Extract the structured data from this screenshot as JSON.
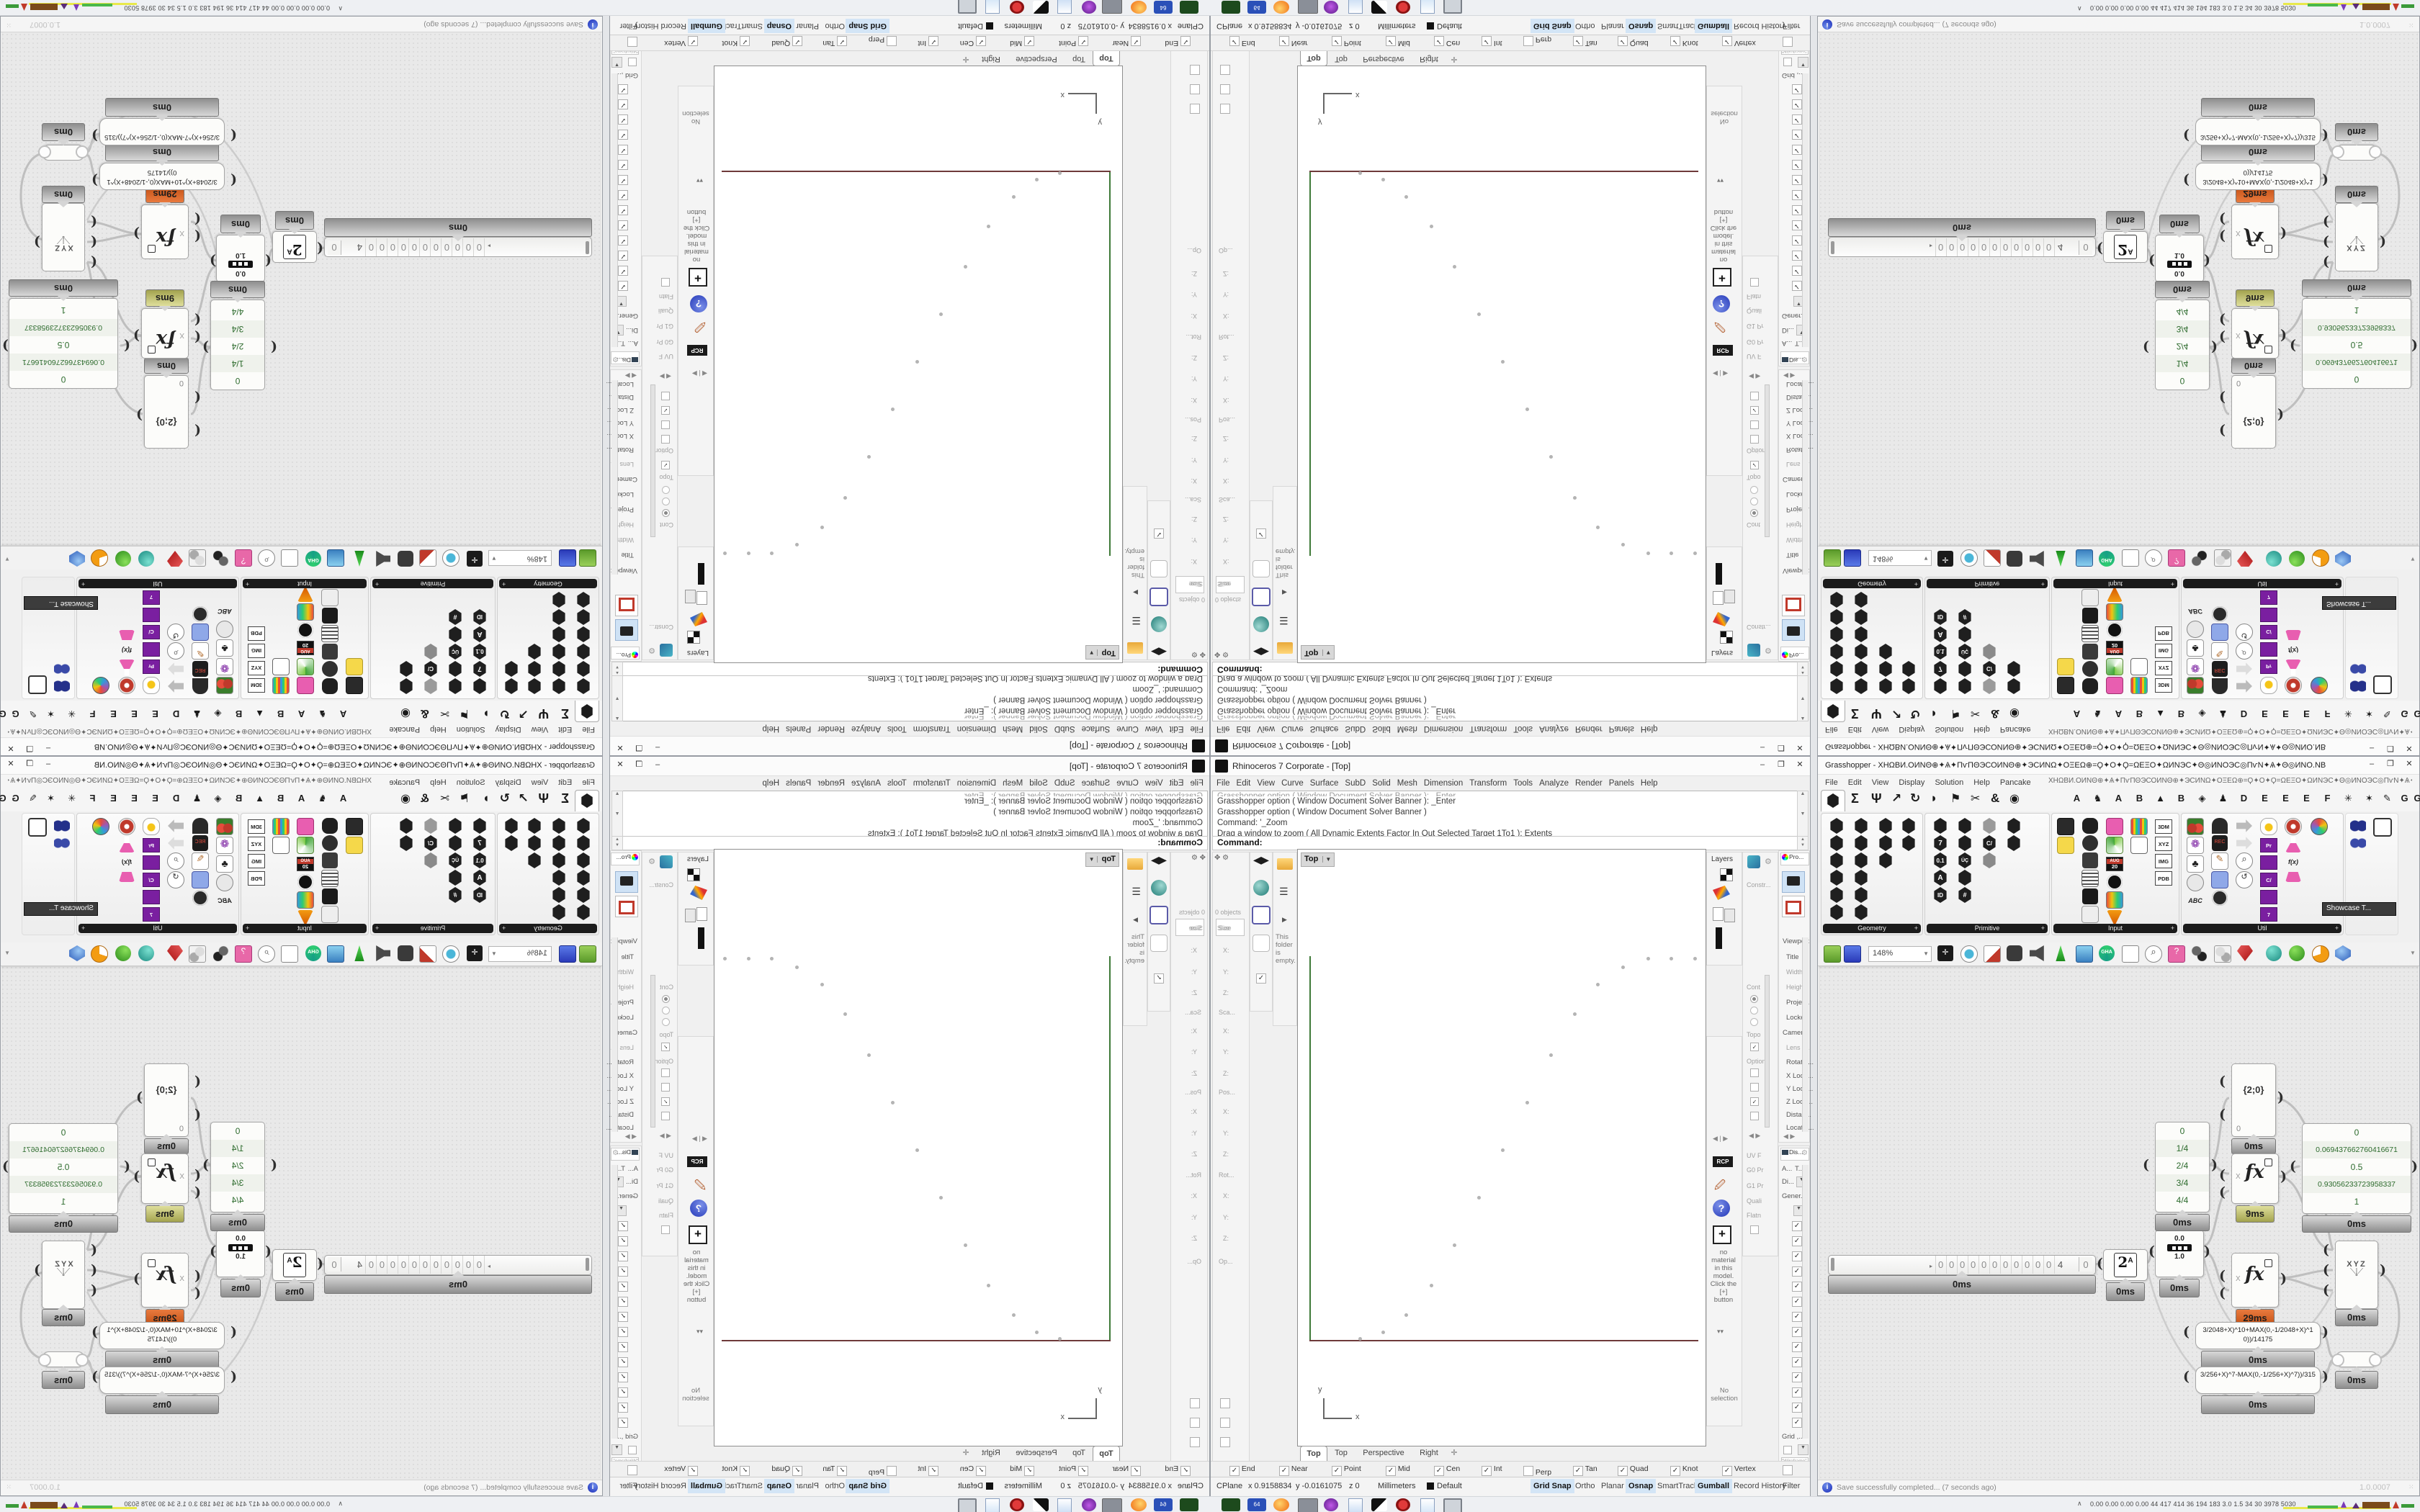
{
  "rhino": {
    "title": "Rhinoceros 7 Corporate - [Top]",
    "buttons": {
      "min": "–",
      "max": "❐",
      "close": "✕"
    },
    "menu": [
      "File",
      "Edit",
      "View",
      "Curve",
      "Surface",
      "SubD",
      "Solid",
      "Mesh",
      "Dimension",
      "Transform",
      "Tools",
      "Analyze",
      "Render",
      "Panels",
      "Help"
    ],
    "command_history": [
      "Grasshopper option ( Window  Document  Solver  Banner ): _Enter",
      "Grasshopper option ( Window  Document  Solver  Banner )",
      "Command: '_Zoom",
      "Drag a window to zoom ( All  Dynamic  Extents  Factor  In  Out  Selected  Target  1To1 ):  Extents"
    ],
    "command_prompt": "Command:",
    "left_panel": {
      "objects": "0 objects",
      "sections": [
        "Size",
        "Sca...",
        "Pos...",
        "Rot...",
        "Op..."
      ],
      "ax": "X:",
      "ay": "Y:",
      "az": "Z:",
      "folder_note": "This folder is empty."
    },
    "viewport": {
      "label": "Top",
      "dd": "▼",
      "axis_x": "x",
      "axis_y": "y"
    },
    "viewport_tabs": [
      "Top",
      "Top",
      "Perspective",
      "Right",
      "✛"
    ],
    "right": {
      "layers": "Layers",
      "constr": "Constr...",
      "constr_items": [
        "Cont",
        "Topo",
        "Option",
        "UV F",
        "G0 Pr",
        "G1 Pr",
        "Quali",
        "Flatn"
      ],
      "props_tab": "Pro...",
      "props": [
        "Viewport",
        "Title",
        "Width",
        "Height",
        "Project.",
        "Locked",
        "Camera",
        "Lens L...",
        "Rotatio...",
        "X Loca...",
        "Y Loca...",
        "Z Loca...",
        "Distan...",
        "Locatio..."
      ],
      "disp_tab": "Dis...",
      "disp_a": "A...",
      "disp_t": "T...",
      "disp_di": "Di...",
      "disp_gen": "Gener...",
      "disp_grid": "Grid ,..",
      "disp_wf": "\"Wireframe\" set...",
      "rcp": "RCP",
      "help": "?",
      "add": "+",
      "mat_note": "no material in this model. Click the [+] button",
      "no_sel": "No selection"
    },
    "osnap": [
      {
        "label": "End",
        "mark": "✓"
      },
      {
        "label": "Near",
        "mark": "✓"
      },
      {
        "label": "Point",
        "mark": "✓"
      },
      {
        "label": "Mid",
        "mark": "✓"
      },
      {
        "label": "Cen",
        "mark": "✓"
      },
      {
        "label": "Int",
        "mark": "✓"
      },
      {
        "label": "Perp",
        "mark": ""
      },
      {
        "label": "Tan",
        "mark": "✓"
      },
      {
        "label": "Quad",
        "mark": "✓"
      },
      {
        "label": "Knot",
        "mark": "✓"
      },
      {
        "label": "Vertex",
        "mark": "✓"
      },
      {
        "label": "Project",
        "mark": ""
      },
      {
        "label": "Disable",
        "mark": ""
      }
    ],
    "status": {
      "cplane": "CPlane",
      "x": "x 0.9158834",
      "y": "y -0.0161075",
      "z": "z 0",
      "units": "Millimeters",
      "layer": "Default",
      "toggles": [
        {
          "label": "Grid Snap"
        },
        {
          "label": "Ortho"
        },
        {
          "label": "Planar"
        },
        {
          "label": "Osnap"
        },
        {
          "label": "SmartTrack"
        },
        {
          "label": "Gumball"
        },
        {
          "label": "Record History"
        },
        {
          "label": "Filter"
        }
      ]
    }
  },
  "gh": {
    "doc": "ХНΩВИ.ОИΝΘ⊕✦Ѧ✦ΠѵΠΘЭСОИΝΘ⊕✦ЭСИΝΩ✦ΟΞΕΩ⊕=Ϙ✦Ο✦Ϙ=ΩΕΞΟ✦ΩИΝЭС✦Θ◎ИΝΟЭС◎ΠѵΝ✦Ѧ✦Θ◎ИΝΟ.ΝΒ",
    "title": "Grasshopper - ХНΩВИ.ОИΝΘ⊕✦Ѧ✦ΠѵΠΘЭСОИΝΘ⊕✦ЭСИΝΩ✦ΟΞΕΩ⊕=Ϙ✦Ο✦Ϙ=ΩΕΞΟ✦ΩИΝЭС✦Θ◎ИΝΟЭС◎ΠѵΝ✦Ѧ✦Θ◎ИΝΟ.ΝΒ",
    "menu": [
      "File",
      "Edit",
      "View",
      "Display",
      "Solution",
      "Help",
      "Pancake"
    ],
    "cat_tabs": [
      "Σ",
      "Ψ",
      "↗",
      "↻",
      "◗",
      "⚑",
      "✂",
      "&",
      "◉"
    ],
    "letter_tabs": [
      "A",
      "♞",
      "A",
      "B",
      "▲",
      "B",
      "◈",
      "♟",
      "D",
      "E",
      "E",
      "E",
      "F",
      "✳",
      "✶",
      "✎",
      "G",
      "G"
    ],
    "groups": [
      "Geometry",
      "Primitive",
      "Input",
      "Util"
    ],
    "group_plus": "+",
    "tooltip": "Showcase T...",
    "zoom": "148%",
    "status": "Save successfully completed... (7 seconds ago)",
    "version": "1.0.0007",
    "chips": {
      "c3dm": "3DM",
      "cxyz": "XYZ",
      "cimg": "IMG",
      "cpdb": "PDB",
      "caug": "AUG",
      "c20": "20",
      "crec": "REC",
      "cpr": "Pr",
      "cfx": "f(x)",
      "cabc": "ABC",
      "c7": "7",
      "c01": "0.1",
      "ca": "A",
      "cid": "ID",
      "ccs": "C/",
      "cuc": "ÜÇ",
      "chash": "#"
    },
    "nodes": {
      "ms0": "0ms",
      "ms9": "9ms",
      "ms29": "29ms",
      "scroller": {
        "digits": [
          "0",
          "0",
          "0",
          "0",
          "0",
          "0",
          "0",
          "0",
          "0",
          "0",
          "0",
          "4"
        ],
        "tail": "0",
        "marker": "▸"
      },
      "pow_base": "2",
      "pow_exp": "A",
      "grad_hi": "0.0",
      "grad_lo": "1.0",
      "panel44": [
        "0",
        "1/4",
        "2/4",
        "3/4",
        "4/4"
      ],
      "bigpanel": [
        "0",
        "0.069437662760416671",
        "0.5",
        "0.93056233723958337",
        "1"
      ],
      "pv_path": "{2;0}",
      "pv_zero": "0",
      "fx_in": "X",
      "xyz": "XYZ",
      "expr1": "3/2048+X)^10+MAX(0,-1/2048+X)^10))/14175",
      "expr2": "3/256+X)^7-MAX(0,-1/256+X)^7))/315"
    }
  },
  "taskbar": {
    "caret": "∧",
    "numbers": "0.00 0.00 0.00 0.00   44   417 414   36   194 183   3.0   1.5   34   30   3978 5030"
  }
}
